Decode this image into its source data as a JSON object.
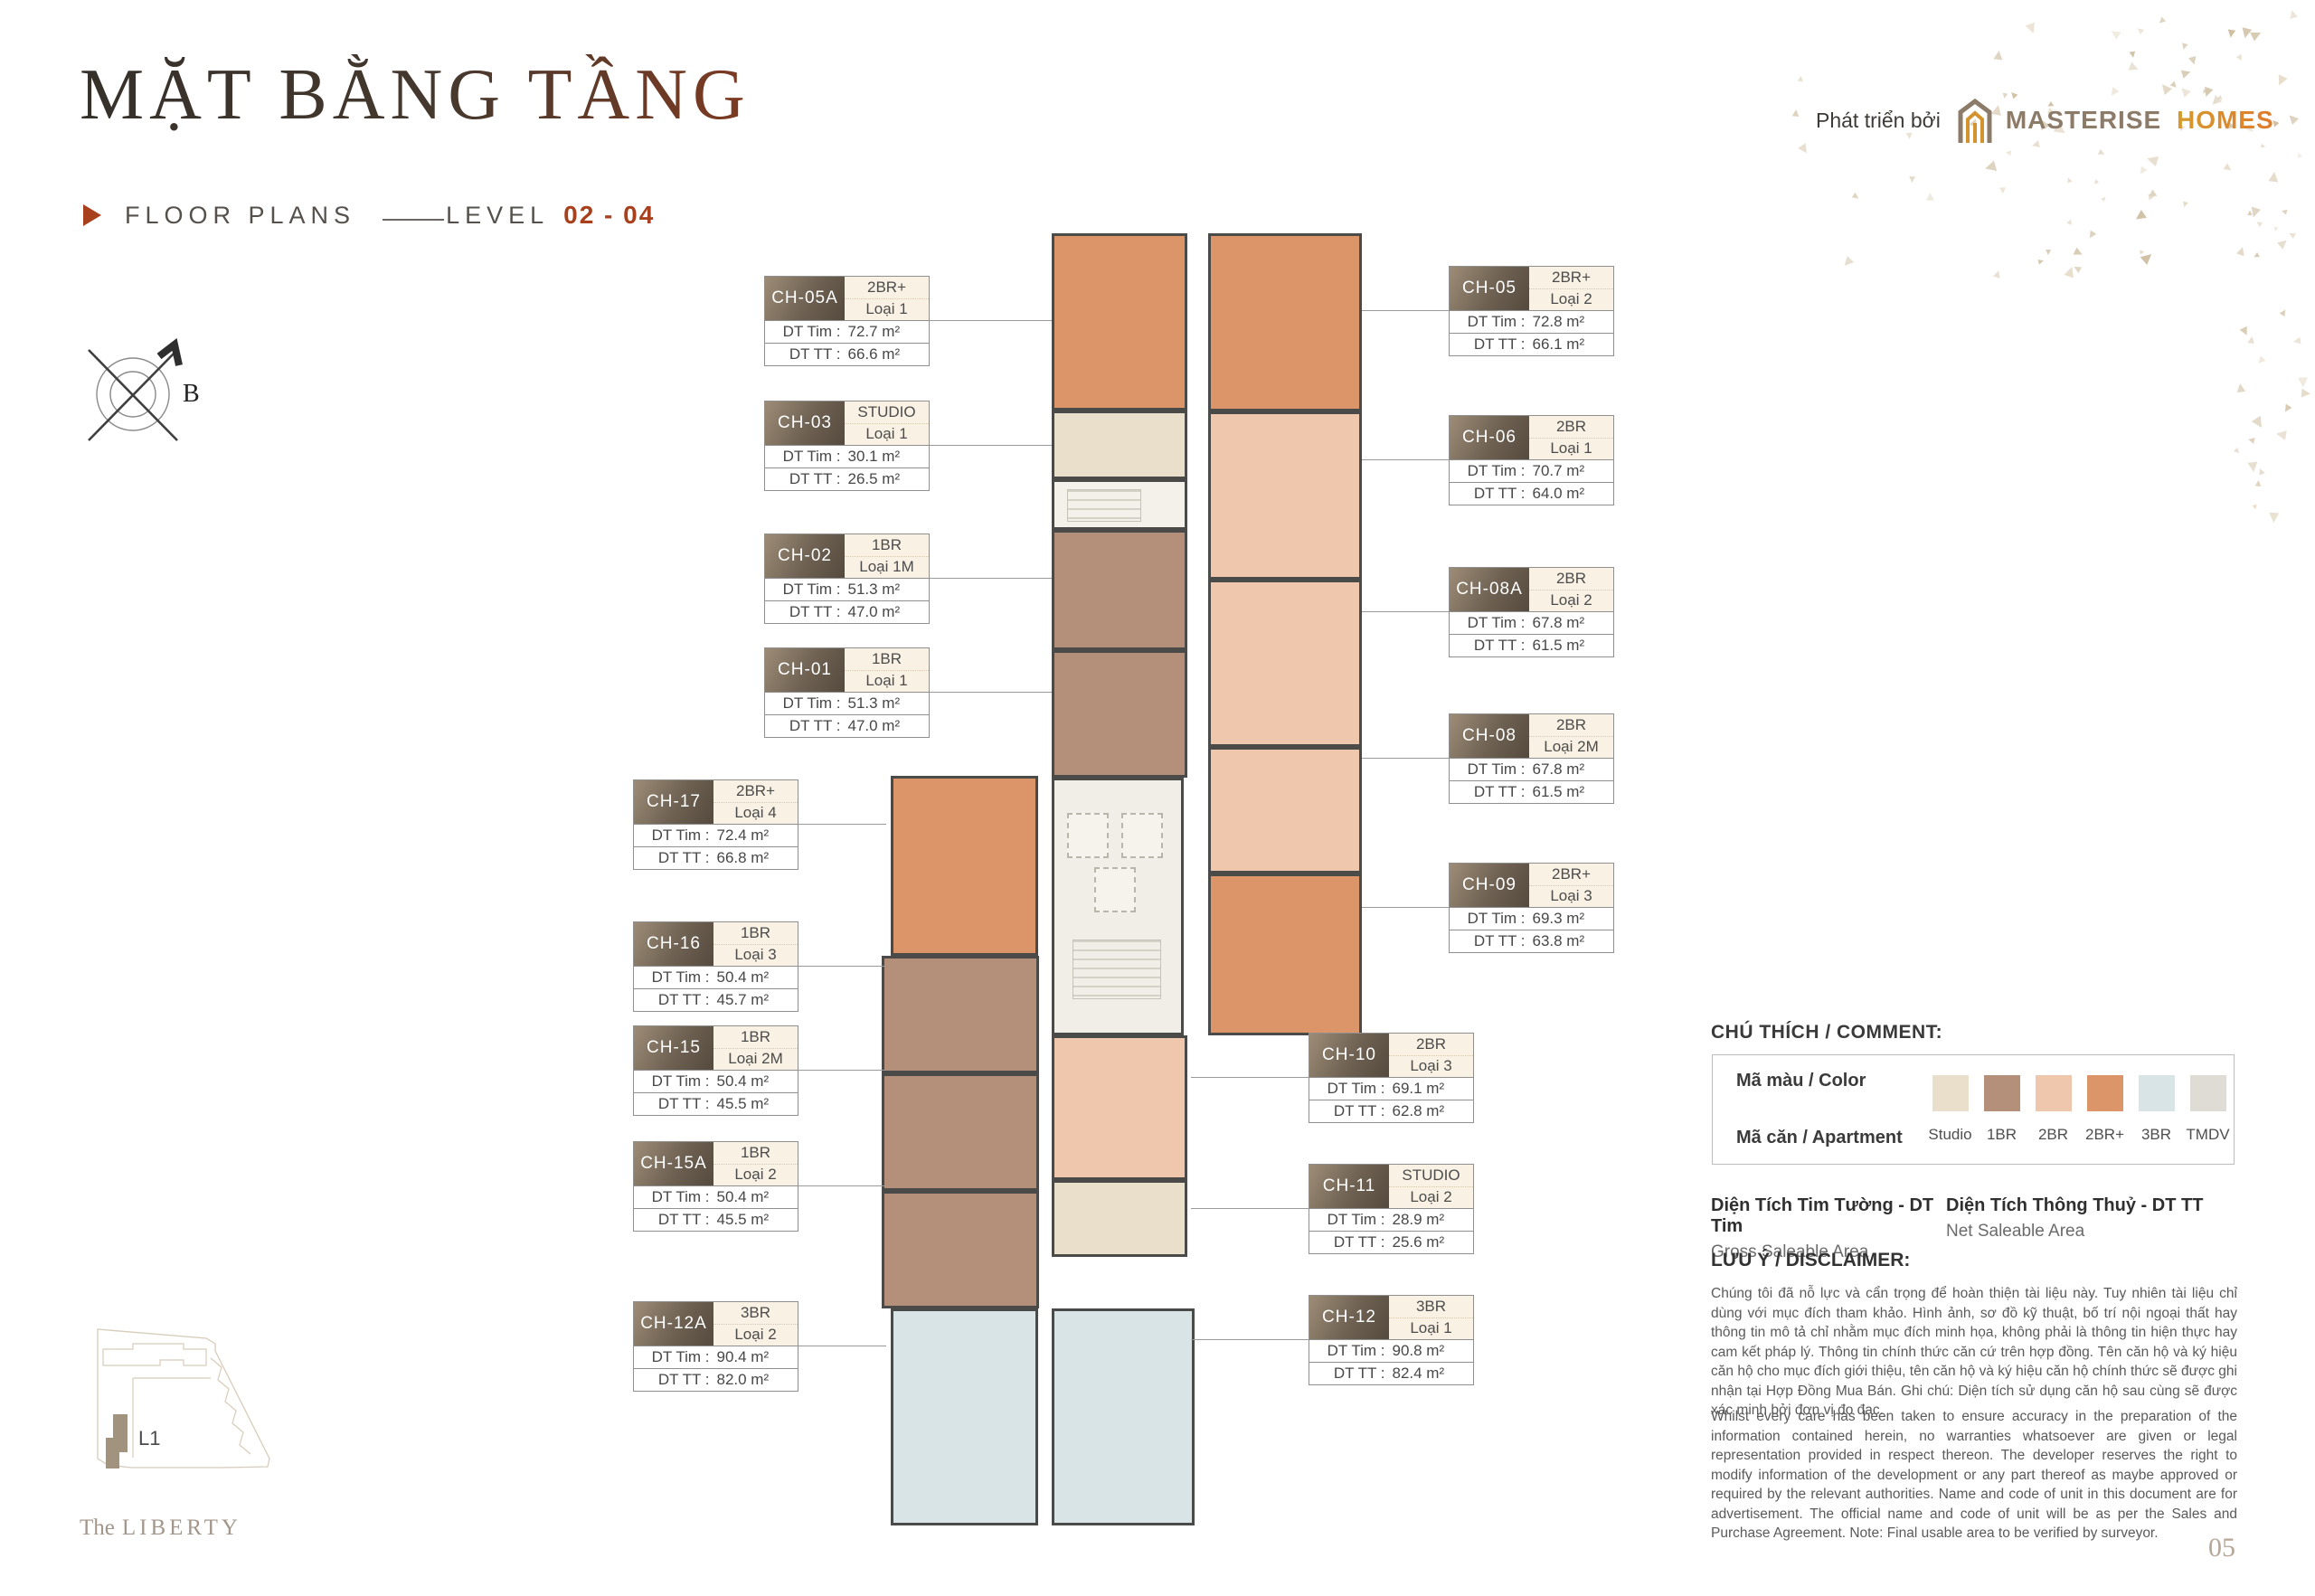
{
  "header": {
    "title": "MẶT BẰNG TẦNG",
    "subtitle_label": "FLOOR PLANS",
    "level_label": "LEVEL",
    "level_value": "02 - 04"
  },
  "developer": {
    "prefix": "Phát triển bởi",
    "brand_primary": "MASTERISE",
    "brand_secondary": "HOMES"
  },
  "theme": {
    "accent": "#a8401d",
    "brand_taupe": "#8c7b69",
    "brand_gold": "#d3932f"
  },
  "compass": {
    "north_label": "B"
  },
  "card_labels": {
    "tim": "DT Tim :",
    "tt": "DT TT :"
  },
  "units": [
    {
      "code": "CH-05A",
      "type": "2BR+",
      "variant": "Loại 1",
      "dt_tim": "72.7 m²",
      "dt_tt": "66.6 m²",
      "group": "left-top"
    },
    {
      "code": "CH-03",
      "type": "STUDIO",
      "variant": "Loại 1",
      "dt_tim": "30.1 m²",
      "dt_tt": "26.5 m²",
      "group": "left-top"
    },
    {
      "code": "CH-02",
      "type": "1BR",
      "variant": "Loại 1M",
      "dt_tim": "51.3 m²",
      "dt_tt": "47.0 m²",
      "group": "left-top"
    },
    {
      "code": "CH-01",
      "type": "1BR",
      "variant": "Loại 1",
      "dt_tim": "51.3 m²",
      "dt_tt": "47.0 m²",
      "group": "left-top"
    },
    {
      "code": "CH-17",
      "type": "2BR+",
      "variant": "Loại 4",
      "dt_tim": "72.4 m²",
      "dt_tt": "66.8 m²",
      "group": "left-bottom"
    },
    {
      "code": "CH-16",
      "type": "1BR",
      "variant": "Loại 3",
      "dt_tim": "50.4 m²",
      "dt_tt": "45.7 m²",
      "group": "left-bottom"
    },
    {
      "code": "CH-15",
      "type": "1BR",
      "variant": "Loại 2M",
      "dt_tim": "50.4 m²",
      "dt_tt": "45.5 m²",
      "group": "left-bottom"
    },
    {
      "code": "CH-15A",
      "type": "1BR",
      "variant": "Loại 2",
      "dt_tim": "50.4 m²",
      "dt_tt": "45.5 m²",
      "group": "left-bottom"
    },
    {
      "code": "CH-12A",
      "type": "3BR",
      "variant": "Loại 2",
      "dt_tim": "90.4 m²",
      "dt_tt": "82.0 m²",
      "group": "left-bottom"
    },
    {
      "code": "CH-05",
      "type": "2BR+",
      "variant": "Loại 2",
      "dt_tim": "72.8 m²",
      "dt_tt": "66.1 m²",
      "group": "right-top"
    },
    {
      "code": "CH-06",
      "type": "2BR",
      "variant": "Loại 1",
      "dt_tim": "70.7 m²",
      "dt_tt": "64.0 m²",
      "group": "right-top"
    },
    {
      "code": "CH-08A",
      "type": "2BR",
      "variant": "Loại 2",
      "dt_tim": "67.8 m²",
      "dt_tt": "61.5 m²",
      "group": "right-top"
    },
    {
      "code": "CH-08",
      "type": "2BR",
      "variant": "Loại 2M",
      "dt_tim": "67.8 m²",
      "dt_tt": "61.5 m²",
      "group": "right-top"
    },
    {
      "code": "CH-09",
      "type": "2BR+",
      "variant": "Loại 3",
      "dt_tim": "69.3 m²",
      "dt_tt": "63.8 m²",
      "group": "right-top"
    },
    {
      "code": "CH-10",
      "type": "2BR",
      "variant": "Loại 3",
      "dt_tim": "69.1 m²",
      "dt_tt": "62.8 m²",
      "group": "right-bottom"
    },
    {
      "code": "CH-11",
      "type": "STUDIO",
      "variant": "Loại 2",
      "dt_tim": "28.9 m²",
      "dt_tt": "25.6 m²",
      "group": "right-bottom"
    },
    {
      "code": "CH-12",
      "type": "3BR",
      "variant": "Loại 1",
      "dt_tim": "90.8 m²",
      "dt_tt": "82.4 m²",
      "group": "right-bottom"
    }
  ],
  "legend": {
    "heading": "CHÚ THÍCH / COMMENT:",
    "color_row_label": "Mã màu / Color",
    "apartment_row_label": "Mã căn / Apartment",
    "items": [
      {
        "key": "studio",
        "label": "Studio",
        "color": "#e9dfcb"
      },
      {
        "key": "1br",
        "label": "1BR",
        "color": "#b48f7a"
      },
      {
        "key": "2br",
        "label": "2BR",
        "color": "#eec7ac"
      },
      {
        "key": "2brp",
        "label": "2BR+",
        "color": "#dc9568"
      },
      {
        "key": "3br",
        "label": "3BR",
        "color": "#d9e4e6"
      },
      {
        "key": "tmdv",
        "label": "TMDV",
        "color": "#dedcd5"
      }
    ]
  },
  "area_definitions": [
    {
      "title": "Diện Tích Tim Tường - DT Tim",
      "subtitle": "Gross Saleable Area"
    },
    {
      "title": "Diện Tích Thông Thuỷ - DT TT",
      "subtitle": "Net Saleable Area"
    }
  ],
  "disclaimer": {
    "heading": "LƯU Ý / DISCLAIMER:",
    "vi": "Chúng tôi đã nỗ lực và cẩn trọng để hoàn thiện tài liệu này. Tuy nhiên tài liệu chỉ dùng với mục đích tham khảo. Hình ảnh, sơ đồ kỹ thuật, bố trí nội ngoại thất hay thông tin mô tả chỉ nhằm mục đích minh họa, không phải là thông tin hiện thực hay cam kết pháp lý. Thông tin chính thức căn cứ trên hợp đồng. Tên căn hộ và ký hiệu căn hộ cho mục đích giới thiệu, tên căn hộ và ký hiệu căn hộ chính thức sẽ được ghi nhận tại Hợp Đồng Mua Bán. Ghi chú: Diện tích sử dụng căn hộ sau cùng sẽ được xác minh bởi đơn vị đo đạc.",
    "en": "Whilst every care has been taken to ensure accuracy in the preparation of the information contained herein, no warranties whatsoever are given or legal representation provided in respect thereon. The developer reserves the right to modify information of the development or any part thereof as maybe approved or required by the relevant authorities. Name and code of unit in this document are for advertisement. The official name and code of unit will be as per the Sales and Purchase Agreement. Note: Final usable area to be verified by surveyor."
  },
  "minimap": {
    "building_label": "L1"
  },
  "footer": {
    "project_prefix": "The",
    "project_name": "LIBERTY",
    "page_number": "05"
  }
}
